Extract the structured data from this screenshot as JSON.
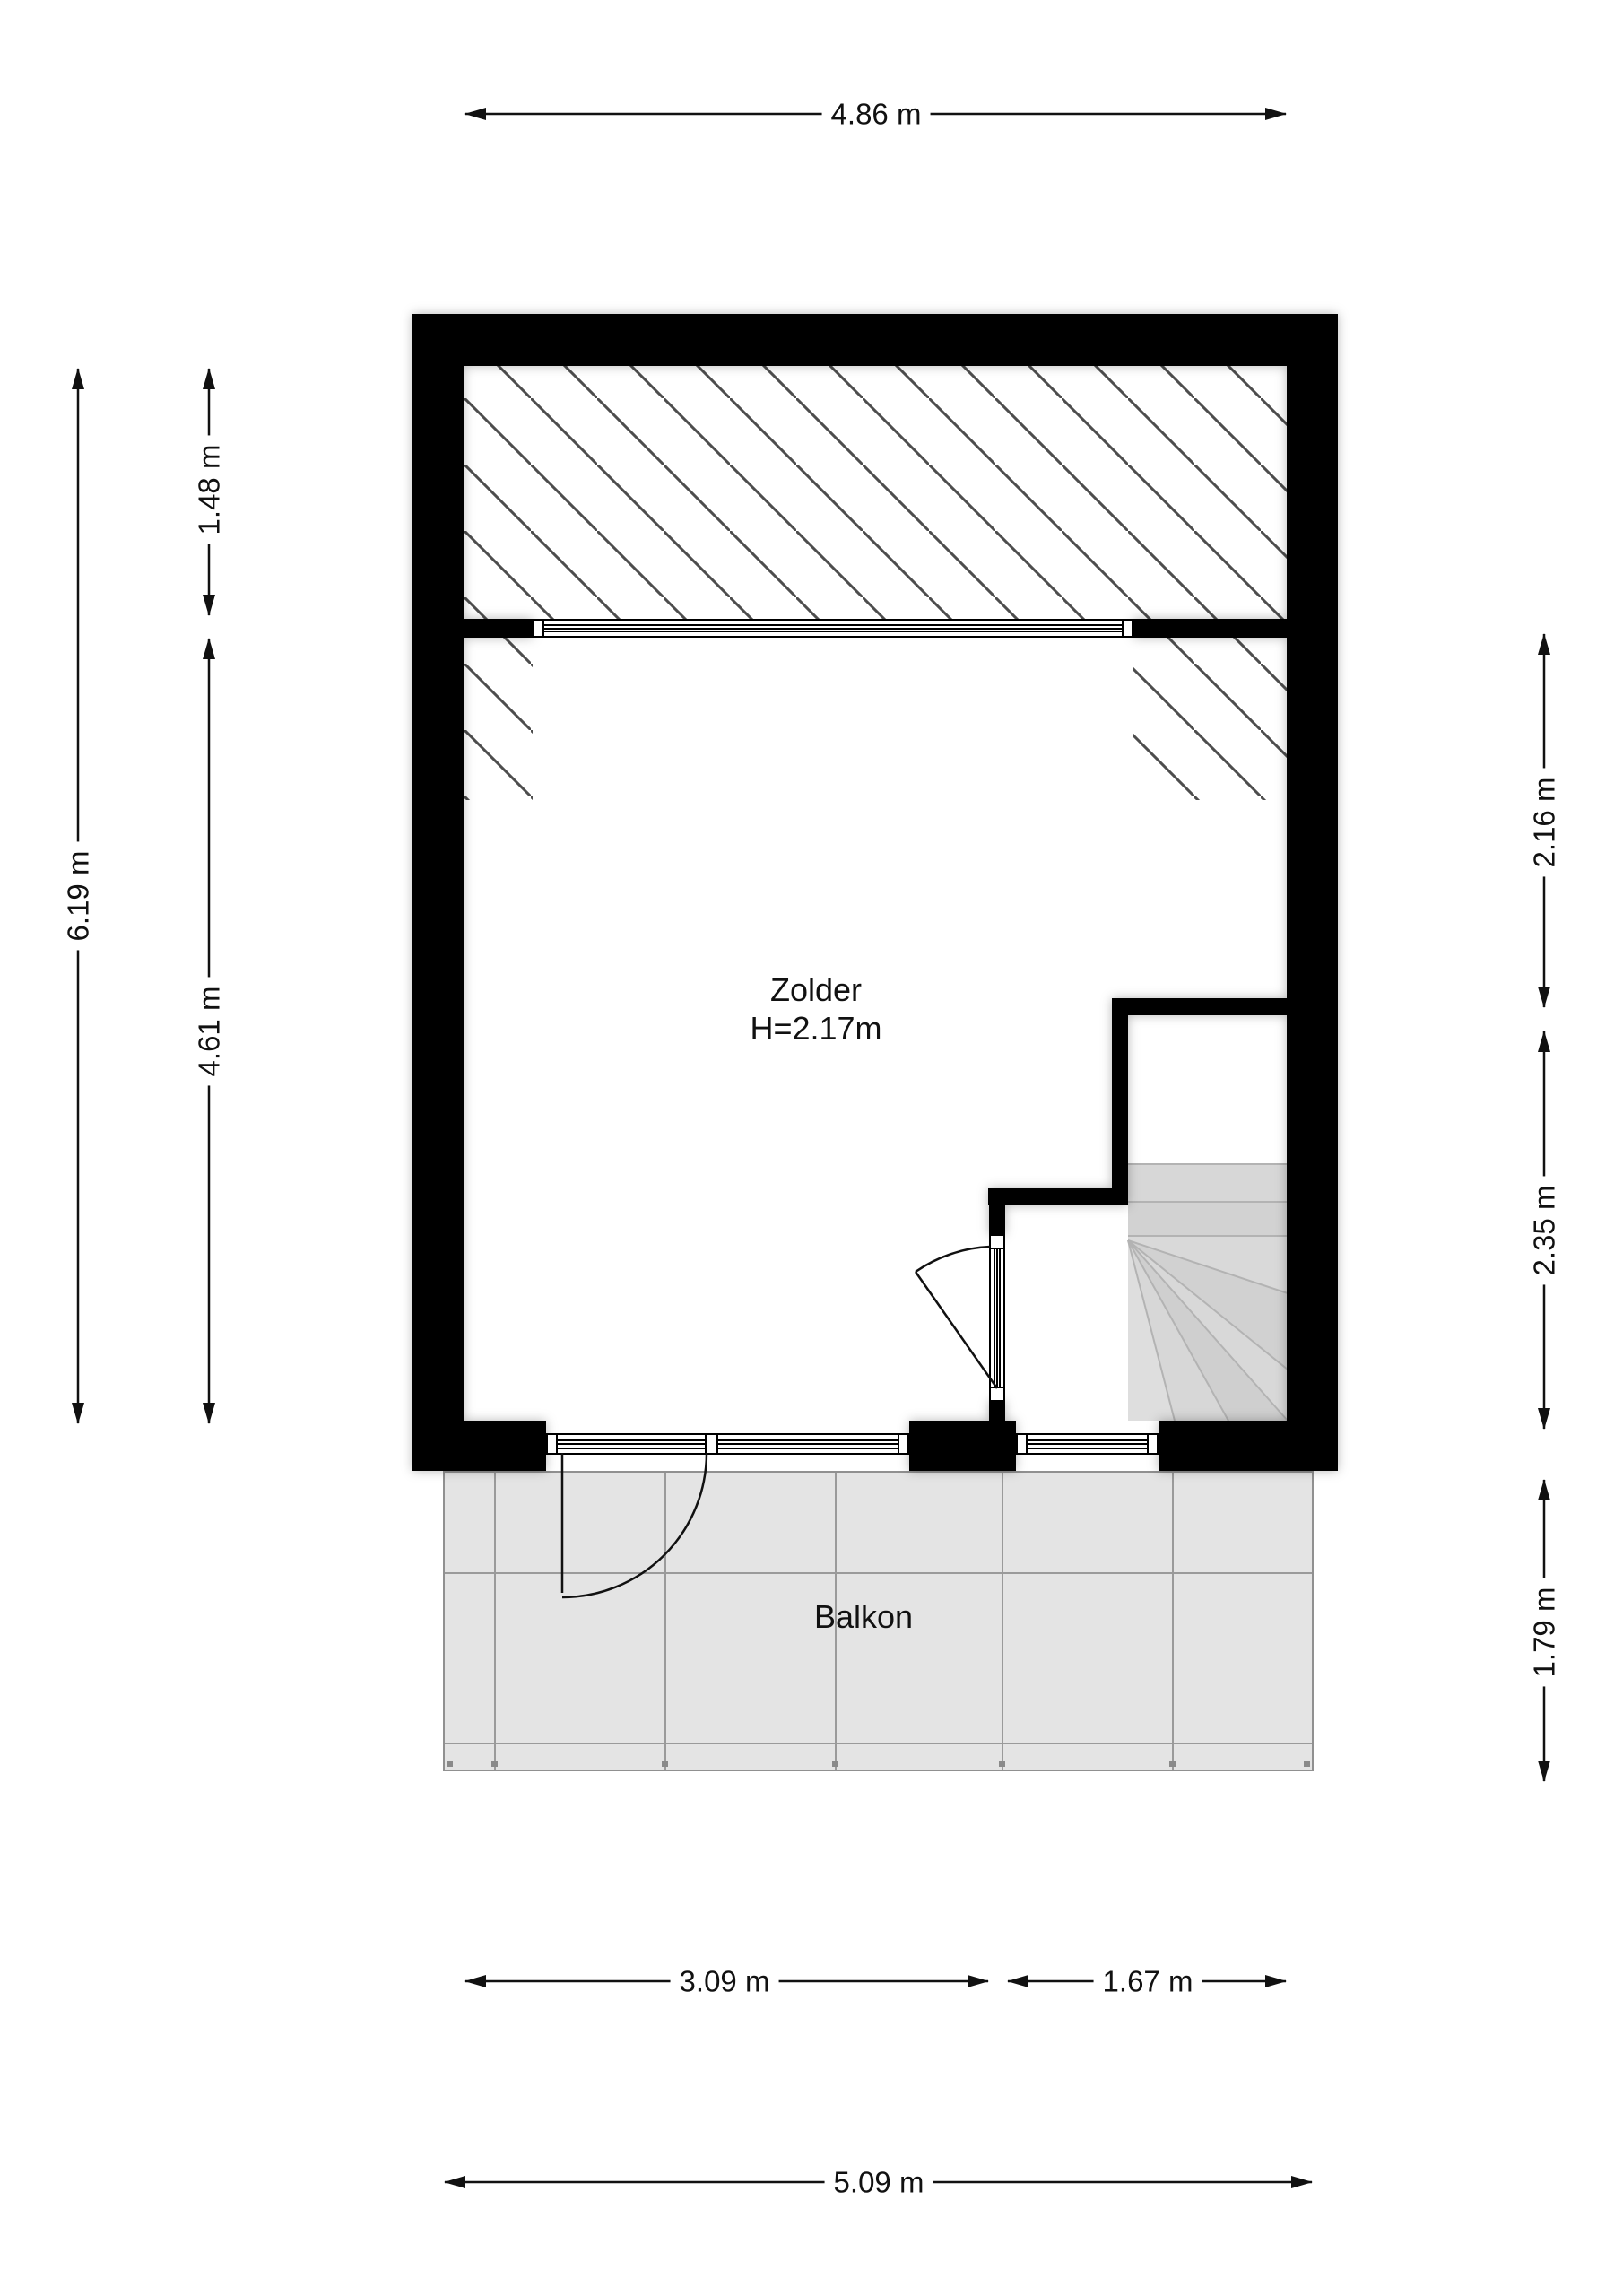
{
  "plan": {
    "room": {
      "name": "Zolder",
      "height": "H=2.17m"
    },
    "balcony": {
      "name": "Balkon"
    }
  },
  "dimensions": {
    "top": "4.86 m",
    "left_outer": "6.19 m",
    "left_inner_upper": "1.48 m",
    "left_inner_lower": "4.61 m",
    "right_upper": "2.16 m",
    "right_middle": "2.35 m",
    "right_lower": "1.79 m",
    "bottom_inner_left": "3.09 m",
    "bottom_inner_right": "1.67 m",
    "bottom_total": "5.09 m"
  },
  "colors": {
    "wall": "#000000",
    "hatch_line": "#4d4d4d",
    "balcony_fill": "#e4e4e4",
    "stair_fill": "#d6d6d6",
    "dimension": "#111111",
    "background": "#ffffff"
  }
}
